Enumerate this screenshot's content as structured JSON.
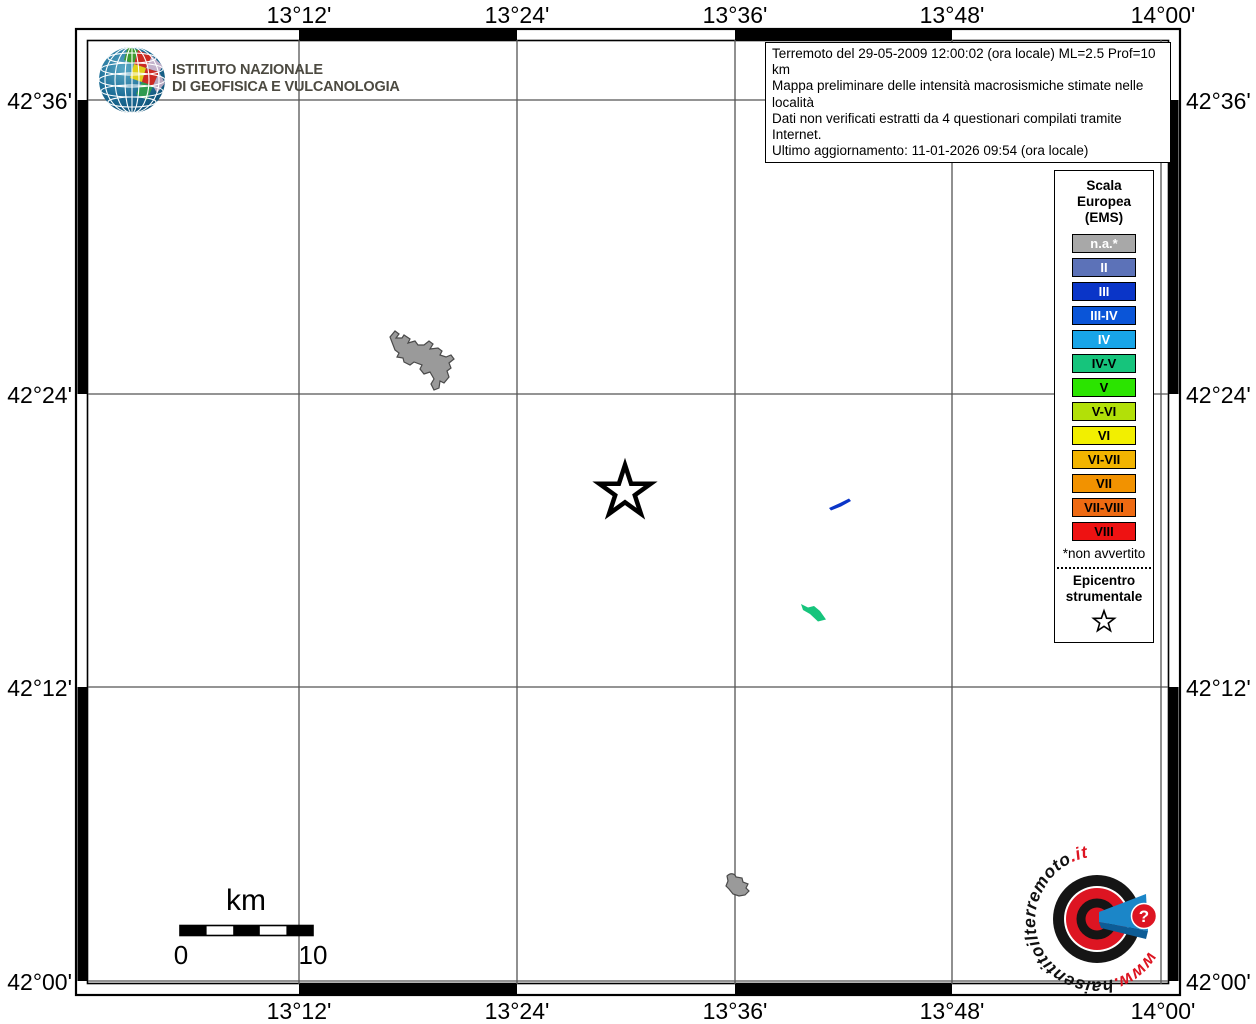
{
  "ingv": {
    "name_line1": "ISTITUTO NAZIONALE",
    "name_line2": "DI GEOFISICA E VULCANOLOGIA"
  },
  "info_box": {
    "line1": "Terremoto del 29-05-2009 12:00:02 (ora locale) ML=2.5 Prof=10 km",
    "line2": "Mappa preliminare delle intensità macrosismiche stimate nelle località",
    "line3": "Dati non verificati estratti da 4 questionari compilati tramite Internet.",
    "line4": "Ultimo aggiornamento: 11-01-2026 09:54 (ora locale)"
  },
  "axes": {
    "top": [
      "13°12'",
      "13°24'",
      "13°36'",
      "13°48'",
      "14°00'"
    ],
    "bottom": [
      "13°12'",
      "13°24'",
      "13°36'",
      "13°48'",
      "14°00'"
    ],
    "left": [
      "42°36'",
      "42°24'",
      "42°12'",
      "42°00'"
    ],
    "right": [
      "42°36'",
      "42°24'",
      "42°12'",
      "42°00'"
    ]
  },
  "legend": {
    "title_line1": "Scala",
    "title_line2": "Europea",
    "title_line3": "(EMS)",
    "items": [
      {
        "label": "n.a.*",
        "color": "#a8a8a8",
        "text_color": "#ffffff"
      },
      {
        "label": "II",
        "color": "#5c72b8",
        "text_color": "#ffffff"
      },
      {
        "label": "III",
        "color": "#0a35c8",
        "text_color": "#ffffff"
      },
      {
        "label": "III-IV",
        "color": "#0a55d8",
        "text_color": "#ffffff"
      },
      {
        "label": "IV",
        "color": "#18a5e8",
        "text_color": "#ffffff"
      },
      {
        "label": "IV-V",
        "color": "#16c47c",
        "text_color": "#000000"
      },
      {
        "label": "V",
        "color": "#2be400",
        "text_color": "#000000"
      },
      {
        "label": "V-VI",
        "color": "#b2e008",
        "text_color": "#000000"
      },
      {
        "label": "VI",
        "color": "#f2ef00",
        "text_color": "#000000"
      },
      {
        "label": "VI-VII",
        "color": "#f2b400",
        "text_color": "#000000"
      },
      {
        "label": "VII",
        "color": "#f29200",
        "text_color": "#000000"
      },
      {
        "label": "VII-VIII",
        "color": "#ee6a12",
        "text_color": "#000000"
      },
      {
        "label": "VIII",
        "color": "#ee1212",
        "text_color": "#000000"
      }
    ],
    "footnote": "*non avvertito",
    "epicenter_line1": "Epicentro",
    "epicenter_line2": "strumentale"
  },
  "scale_bar": {
    "unit_label": "km",
    "min_label": "0",
    "max_label": "10"
  },
  "site_logo": {
    "text_www": "www.",
    "text_main": "haisentitoilterremoto",
    "text_it": ".it",
    "question_mark": "?",
    "accent_color": "#dd1522",
    "megaphone_color": "#1b86c8"
  },
  "map_features": {
    "lake_color": "#9a9a9a",
    "lake_outline_color": "#4a4a4a",
    "intensity_iii_feature_color": "#0a35c8",
    "intensity_iv_v_feature_color": "#16c47c"
  }
}
